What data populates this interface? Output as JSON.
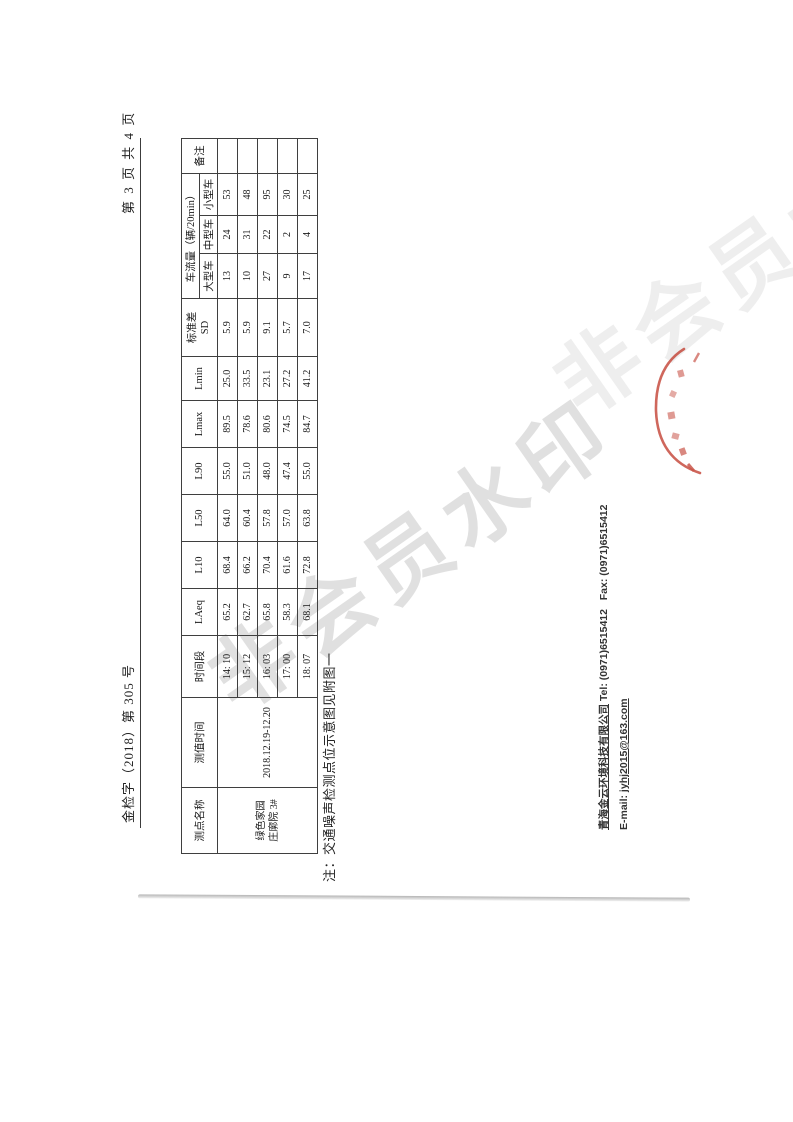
{
  "page": {
    "doc_number": "金检字（2018）第 305 号",
    "page_indicator": "第 3 页 共 4 页"
  },
  "table": {
    "headers": {
      "point_name": "测点名称",
      "measure_time": "测值时间",
      "time_period": "时间段",
      "laeq": "LAeq",
      "l10": "L10",
      "l50": "L50",
      "l90": "L90",
      "lmax": "Lmax",
      "lmin": "Lmin",
      "sd_line1": "标准差",
      "sd_line2": "SD",
      "traffic_group": "车流量（辆/20min）",
      "large_vehicle": "大型车",
      "medium_vehicle": "中型车",
      "small_vehicle": "小型车",
      "remark": "备注"
    },
    "point_name_line1": "绿色家园",
    "point_name_line2": "庄廓院 3#",
    "measure_time": "2018.12.19-12.20",
    "rows": [
      {
        "time": "14: 10",
        "laeq": "65.2",
        "l10": "68.4",
        "l50": "64.0",
        "l90": "55.0",
        "lmax": "89.5",
        "lmin": "25.0",
        "sd": "5.9",
        "large": "13",
        "medium": "24",
        "small": "53",
        "remark": ""
      },
      {
        "time": "15: 12",
        "laeq": "62.7",
        "l10": "66.2",
        "l50": "60.4",
        "l90": "51.0",
        "lmax": "78.6",
        "lmin": "33.5",
        "sd": "5.9",
        "large": "10",
        "medium": "31",
        "small": "48",
        "remark": ""
      },
      {
        "time": "16: 03",
        "laeq": "65.8",
        "l10": "70.4",
        "l50": "57.8",
        "l90": "48.0",
        "lmax": "80.6",
        "lmin": "23.1",
        "sd": "9.1",
        "large": "27",
        "medium": "22",
        "small": "95",
        "remark": ""
      },
      {
        "time": "17: 00",
        "laeq": "58.3",
        "l10": "61.6",
        "l50": "57.0",
        "l90": "47.4",
        "lmax": "74.5",
        "lmin": "27.2",
        "sd": "5.7",
        "large": "9",
        "medium": "2",
        "small": "30",
        "remark": ""
      },
      {
        "time": "18: 07",
        "laeq": "68.1",
        "l10": "72.8",
        "l50": "63.8",
        "l90": "55.0",
        "lmax": "84.7",
        "lmin": "41.2",
        "sd": "7.0",
        "large": "17",
        "medium": "4",
        "small": "25",
        "remark": ""
      }
    ]
  },
  "note": "注：交通噪声检测点位示意图见附图一",
  "footer": {
    "company": "青海金云环境科技有限公司",
    "tel_label": "Tel:",
    "tel": "(0971)6515412",
    "fax_label": "Fax:",
    "fax": "(0971)6515412",
    "email_label": "E-mail:",
    "email": "jyhj2015@163.com"
  },
  "watermark": "非会员水印",
  "colors": {
    "stamp_red": "#c0392b",
    "watermark_gray": "#d0d0d0"
  }
}
